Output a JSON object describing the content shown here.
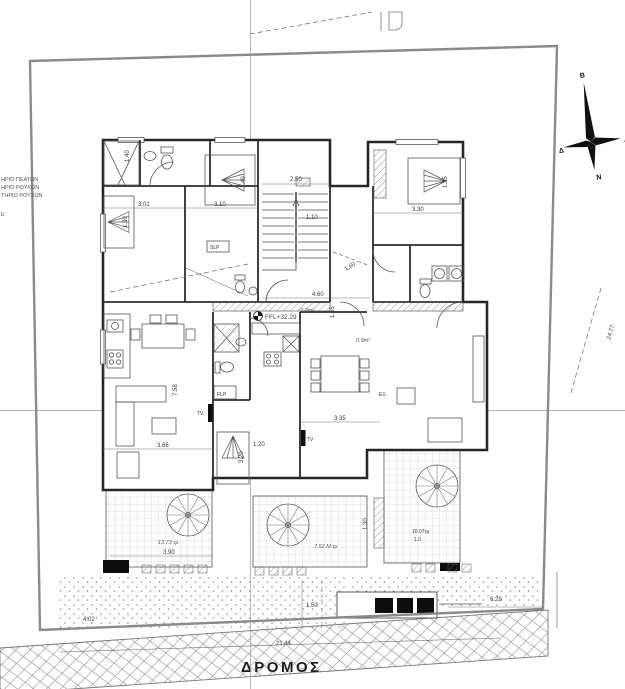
{
  "drawing": {
    "road": {
      "label": "ΔΡΟΜΟΣ",
      "length_dim": "21.44",
      "sidewalk_dim": "1.50"
    },
    "site": {
      "dim_bottom_left": "4.02",
      "dim_bottom_right": "6.29",
      "dim_right_side": "24.77"
    },
    "level_marker": {
      "label": "FFL+32.29"
    },
    "compass": {
      "north": "Β",
      "south": "Ν",
      "east": "Α",
      "west": "Δ"
    },
    "legend_left": {
      "line1": "ΗΡΙΟ ΠΕΑΤΩΝ",
      "line2": "ΗΡΙΟ ΡΟΥΧΩΝ",
      "line3": "ΤΗΡΙΟ ΡΟΥΧΩΝ",
      "line4": "Ε"
    },
    "dimensions": {
      "bedroom1_width": "3.01",
      "bedroom1_bed": "1.30",
      "bathroom1_width": "1.40",
      "bedroom2_width": "3.10",
      "bedroom2_bed": "1.40",
      "bedroom3_width": "3.30",
      "bedroom3_bed": "1.35",
      "stairs_width": "2.50",
      "stairs_depth": "1.10",
      "corridor": "1.60",
      "hall_width": "4.60",
      "hall_depth": "1.55",
      "living1_depth": "7.58",
      "living1_width": "3.66",
      "studio_bed_length": "3.20",
      "studio_bed_width": "1.20",
      "living2_width": "3.35",
      "balcony_left_width": "3.90",
      "balcony_mid_depth": "1.30"
    },
    "areas": {
      "hall": "2.2m²",
      "wc": "0.9m²",
      "balcony_left": "13.73 τμ",
      "balcony_mid": "7.52 Μ.τμ",
      "balcony_right": "10.07τμ",
      "balcony_right_note": "1.0"
    },
    "labels": {
      "tv_left": "TV.",
      "tv_right": "TV",
      "flp": "FLP",
      "slp": "SLP",
      "exit": "ΕΞ."
    }
  }
}
